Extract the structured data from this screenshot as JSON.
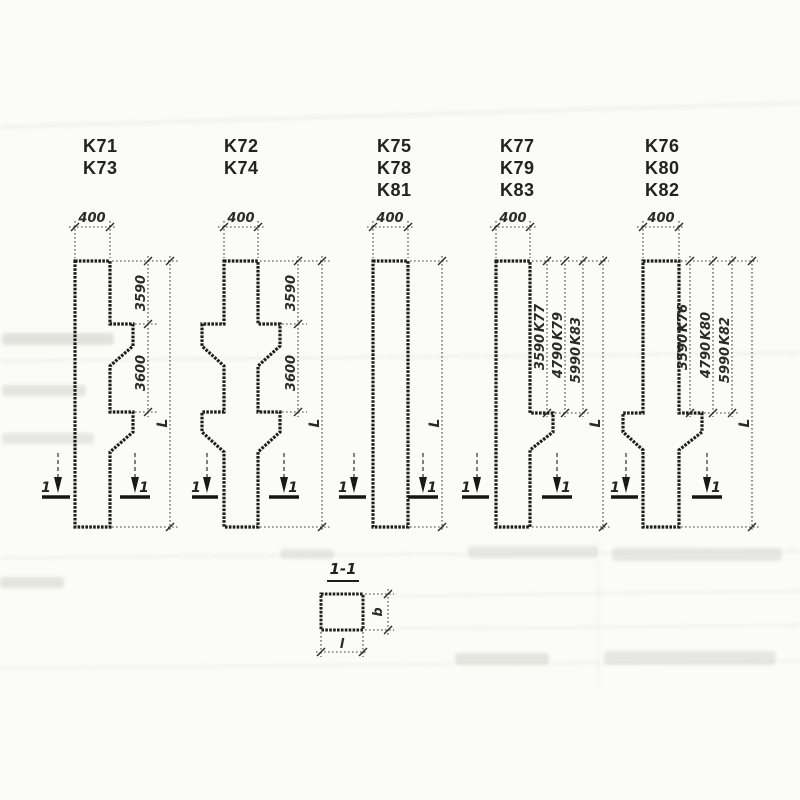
{
  "drawing": {
    "ink_color": "#1d1d1d",
    "background_color": "#fbfbf8",
    "columns": [
      {
        "variant_labels": [
          "K71",
          "K73"
        ],
        "top_width": "400",
        "segment_dims": [
          "3590",
          "3600"
        ],
        "length_label": "L",
        "section_mark": "1"
      },
      {
        "variant_labels": [
          "K72",
          "K74"
        ],
        "top_width": "400",
        "segment_dims": [
          "3590",
          "3600"
        ],
        "length_label": "L",
        "section_mark": "1"
      },
      {
        "variant_labels": [
          "K75",
          "K78",
          "K81"
        ],
        "top_width": "400",
        "segment_dims": [],
        "length_label": "L",
        "section_mark": "1"
      },
      {
        "variant_labels": [
          "K77",
          "K79",
          "K83"
        ],
        "top_width": "400",
        "variant_dims": [
          {
            "value": "3590",
            "variant": "K77"
          },
          {
            "value": "4790",
            "variant": "K79"
          },
          {
            "value": "5990",
            "variant": "K83"
          }
        ],
        "length_label": "L",
        "section_mark": "1"
      },
      {
        "variant_labels": [
          "K76",
          "K80",
          "K82"
        ],
        "top_width": "400",
        "variant_dims": [
          {
            "value": "3590",
            "variant": "K76"
          },
          {
            "value": "4790",
            "variant": "K80"
          },
          {
            "value": "5990",
            "variant": "K82"
          }
        ],
        "length_label": "L",
        "section_mark": "1"
      }
    ],
    "section_detail": {
      "title": "1-1",
      "width_label": "l",
      "depth_label": "b"
    }
  }
}
